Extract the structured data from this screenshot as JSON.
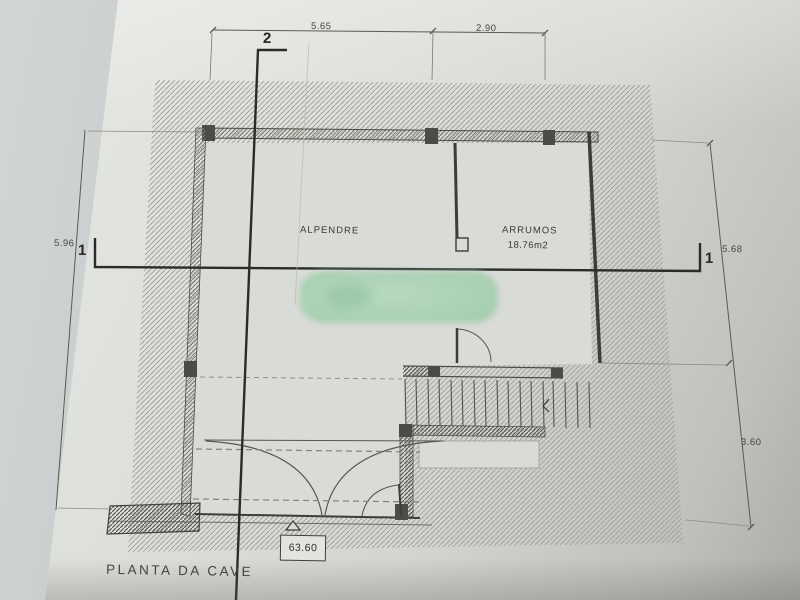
{
  "document": {
    "type_note": "scanned architectural basement floor plan photo",
    "title": "PLANTA DA CAVE",
    "rooms": {
      "alpendre": {
        "name": "ALPENDRE"
      },
      "arrumos": {
        "name": "ARRUMOS",
        "area": "18.76m2"
      }
    },
    "dimensions": {
      "top": [
        "5.65",
        "2.90"
      ],
      "left": [
        "5.96"
      ],
      "right": [
        "5.68",
        "3.60"
      ]
    },
    "level": {
      "value": "63.60"
    },
    "sections": {
      "vertical_cut": {
        "label": "2"
      },
      "horizontal_cut": {
        "label": "1"
      }
    },
    "colors": {
      "paper": "#d8dad5",
      "ink": "#3c3d38",
      "hatch_light": "#a2a49c",
      "hatch_wall": "#83847c",
      "redaction_green": "#a6d1b1"
    }
  }
}
